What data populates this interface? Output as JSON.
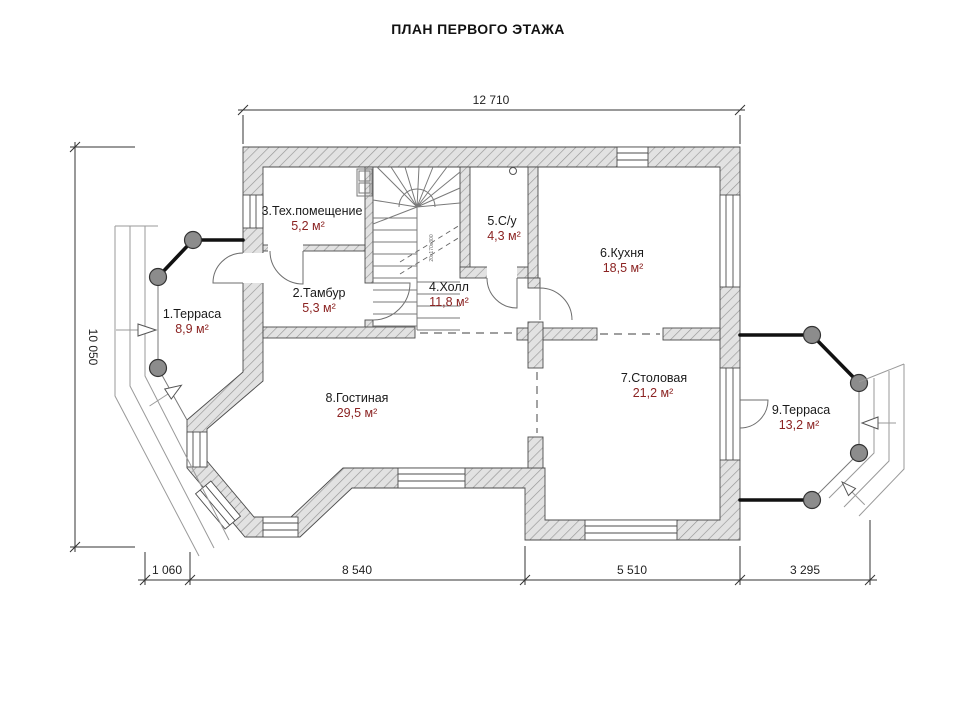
{
  "title": "ПЛАН ПЕРВОГО ЭТАЖА",
  "rooms": [
    {
      "name": "1.Терраса",
      "area": "8,9 м²"
    },
    {
      "name": "2.Тамбур",
      "area": "5,3 м²"
    },
    {
      "name": "3.Тех.помещение",
      "area": "5,2 м²"
    },
    {
      "name": "4.Холл",
      "area": "11,8 м²"
    },
    {
      "name": "5.С/у",
      "area": "4,3 м²"
    },
    {
      "name": "6.Кухня",
      "area": "18,5 м²"
    },
    {
      "name": "7.Столовая",
      "area": "21,2 м²"
    },
    {
      "name": "8.Гостиная",
      "area": "29,5 м²"
    },
    {
      "name": "9.Терраса",
      "area": "13,2 м²"
    }
  ],
  "dimensions": {
    "top": "12 710",
    "left": "10 050",
    "bottom": [
      "1 060",
      "8 540",
      "5 510",
      "3 295"
    ]
  },
  "stairs": {
    "note": "20x170x300"
  },
  "colors": {
    "room_label": "#1a1a1a",
    "room_area": "#8b2322"
  }
}
